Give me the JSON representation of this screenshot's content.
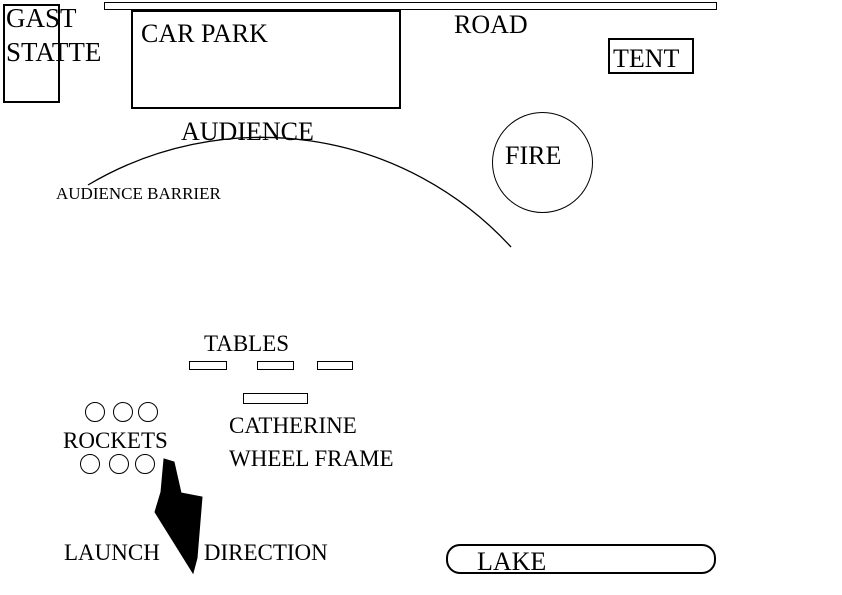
{
  "diagram": {
    "type": "firework-display-site-plan",
    "colors": {
      "ink": "#000000",
      "background": "#ffffff"
    },
    "guesthouse": {
      "line1": "GAST",
      "line2": "STATTE"
    },
    "road": {
      "label": "ROAD"
    },
    "car_park": {
      "label": "CAR PARK"
    },
    "tent": {
      "label": "TENT"
    },
    "audience": {
      "label": "AUDIENCE"
    },
    "audience_barrier": {
      "label": "AUDIENCE BARRIER"
    },
    "fire": {
      "label": "FIRE"
    },
    "tables": {
      "label": "TABLES",
      "table_count": 3
    },
    "catherine_wheel": {
      "line1": "CATHERINE",
      "line2": "WHEEL FRAME"
    },
    "rockets": {
      "label": "ROCKETS",
      "rocket_count": 6
    },
    "launch": {
      "word1": "LAUNCH",
      "word2": "DIRECTION"
    },
    "lake": {
      "label": "LAKE"
    }
  }
}
